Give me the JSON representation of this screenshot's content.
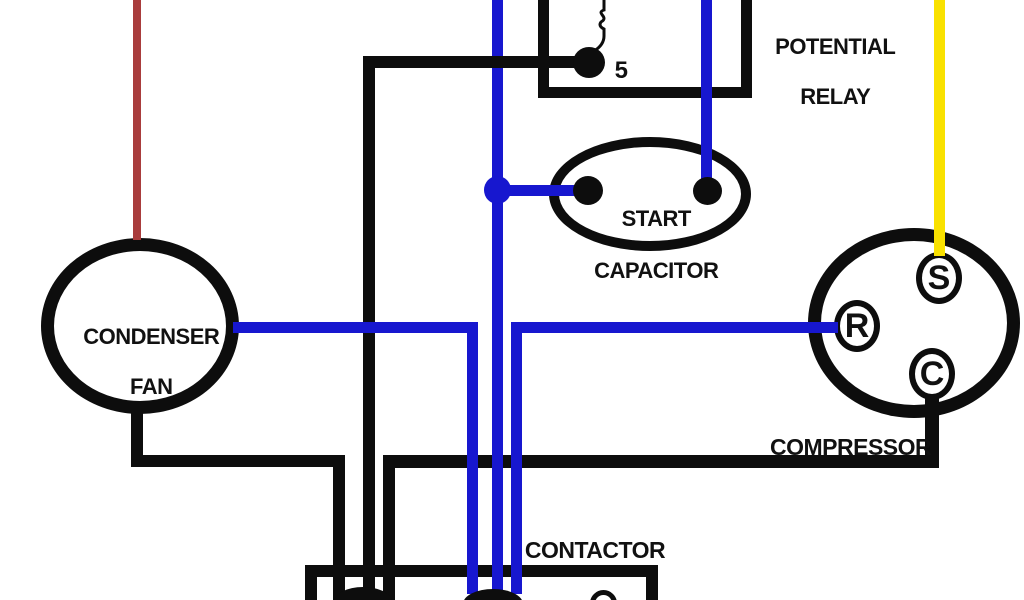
{
  "diagram": {
    "potential_relay": {
      "line1": "POTENTIAL",
      "line2": "RELAY",
      "terminal_label": "5"
    },
    "start_capacitor": {
      "line1": "START",
      "line2": "CAPACITOR"
    },
    "condenser_fan": {
      "line1": "CONDENSER",
      "line2": "FAN"
    },
    "compressor": {
      "label": "COMPRESSOR",
      "terminal_s": "S",
      "terminal_r": "R",
      "terminal_c": "C"
    },
    "contactor": {
      "label": "CONTACTOR"
    }
  },
  "colors": {
    "wire_black": "#0d0d0d",
    "wire_blue": "#1717cf",
    "wire_red": "#a93c3c",
    "wire_yellow": "#f9e100",
    "background": "#ffffff",
    "text": "#111111"
  }
}
